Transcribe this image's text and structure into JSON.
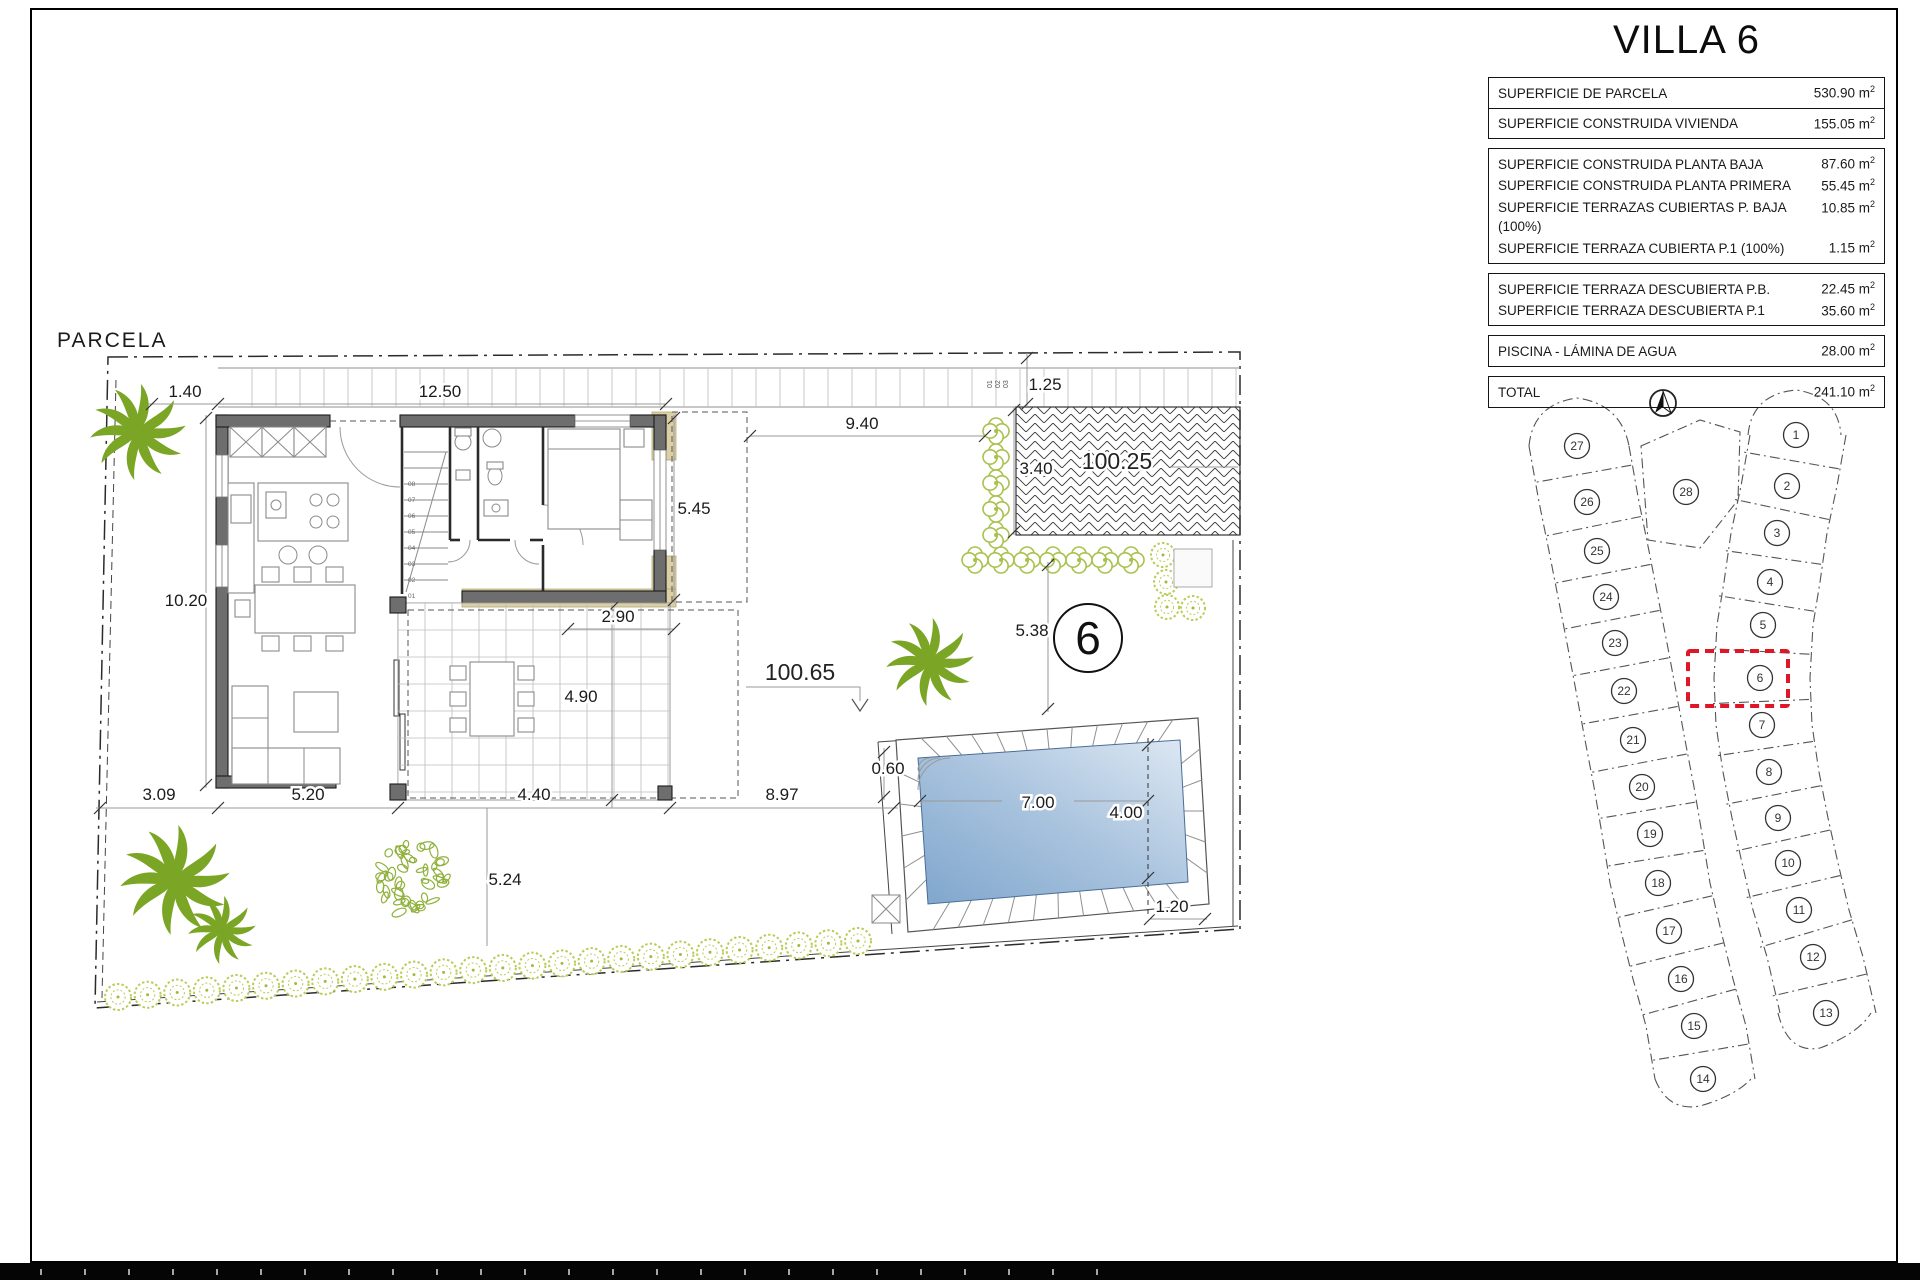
{
  "title_block": {
    "title": "VILLA 6",
    "unit_base": "m",
    "unit_sup": "2",
    "groups": [
      {
        "split": true,
        "rows": [
          {
            "label": "SUPERFICIE DE PARCELA",
            "value": "530.90"
          },
          {
            "label": "SUPERFICIE CONSTRUIDA VIVIENDA",
            "value": "155.05"
          }
        ]
      },
      {
        "split": false,
        "rows": [
          {
            "label": "SUPERFICIE CONSTRUIDA PLANTA BAJA",
            "value": "87.60"
          },
          {
            "label": "SUPERFICIE CONSTRUIDA PLANTA PRIMERA",
            "value": "55.45"
          },
          {
            "label": "SUPERFICIE TERRAZAS CUBIERTAS P. BAJA (100%)",
            "value": "10.85"
          },
          {
            "label": "SUPERFICIE TERRAZA CUBIERTA P.1 (100%)",
            "value": "1.15"
          }
        ]
      },
      {
        "split": false,
        "rows": [
          {
            "label": "SUPERFICIE TERRAZA DESCUBIERTA P.B.",
            "value": "22.45"
          },
          {
            "label": "SUPERFICIE TERRAZA DESCUBIERTA P.1",
            "value": "35.60"
          }
        ]
      },
      {
        "split": false,
        "rows": [
          {
            "label": "PISCINA - LÁMINA DE AGUA",
            "value": "28.00"
          }
        ]
      },
      {
        "split": false,
        "rows": [
          {
            "label": "TOTAL",
            "value": "241.10"
          }
        ]
      }
    ]
  },
  "plan": {
    "parcela_label": "PARCELA",
    "villa_number": "6",
    "levels": {
      "garden": "100.65",
      "driveway": "100.25"
    },
    "dims": {
      "d140": "1.40",
      "d1250": "12.50",
      "d940": "9.40",
      "d125": "1.25",
      "d340": "3.40",
      "d545": "5.45",
      "d1020": "10.20",
      "d290": "2.90",
      "d490": "4.90",
      "d538": "5.38",
      "d309": "3.09",
      "d520": "5.20",
      "d440": "4.40",
      "d897": "8.97",
      "d524": "5.24",
      "d060": "0.60",
      "d700": "7.00",
      "d400": "4.00",
      "d120": "1.20"
    },
    "stair_steps": [
      "01",
      "02",
      "03",
      "04",
      "05",
      "06",
      "07",
      "08"
    ],
    "parking_labels": [
      "01",
      "02",
      "03"
    ]
  },
  "sitemap": {
    "selected": "6",
    "plots": [
      "1",
      "2",
      "3",
      "4",
      "5",
      "6",
      "7",
      "8",
      "9",
      "10",
      "11",
      "12",
      "13",
      "14",
      "15",
      "16",
      "17",
      "18",
      "19",
      "20",
      "21",
      "22",
      "23",
      "24",
      "25",
      "26",
      "27",
      "28"
    ]
  },
  "colors": {
    "accent_red": "#de1626",
    "palm_green": "#7aa525",
    "bush_green": "#a9c24d",
    "pool_blue": "#7fa6cd",
    "tan": "#dbcfa6",
    "wall_gray": "#6e6e6e"
  }
}
